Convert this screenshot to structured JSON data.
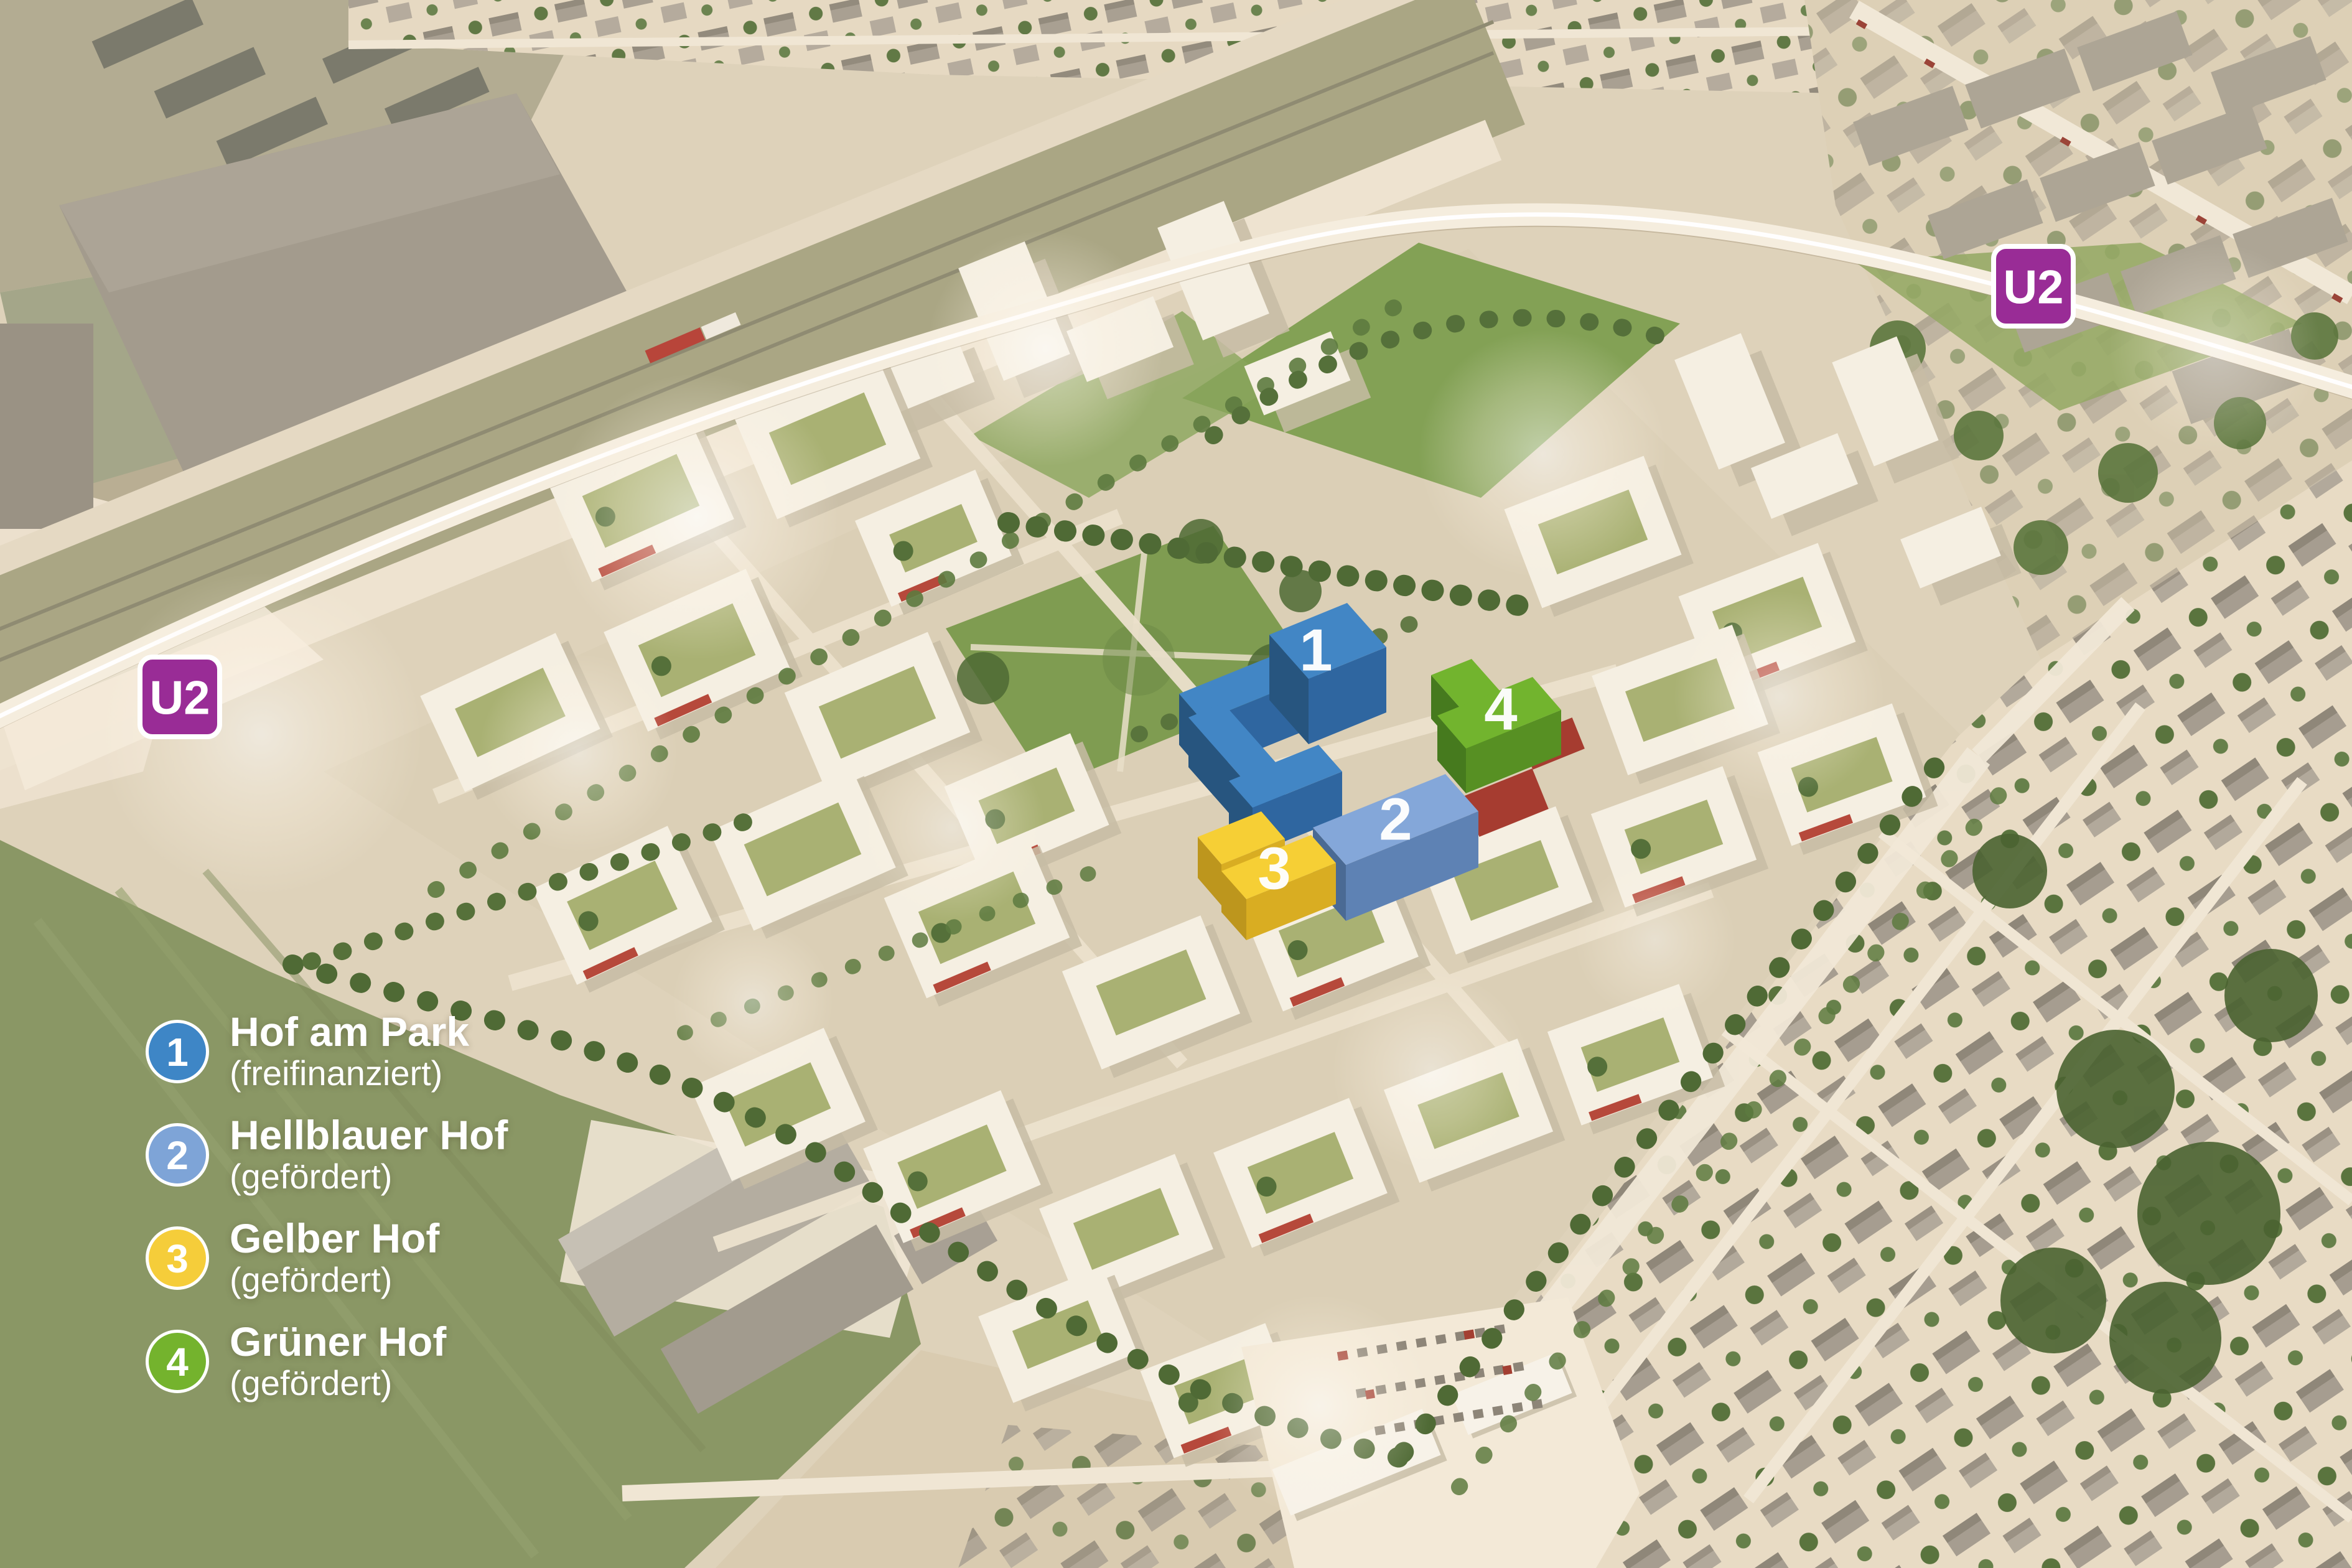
{
  "scene": {
    "description": "Aerial masterplan rendering of a new housing quarter along the U2 metro line",
    "ground_color": "#ded2ba"
  },
  "u2_line": {
    "badge_color": "#992c96",
    "badge_border": "#ffffff"
  },
  "badges": [
    {
      "id": "west",
      "label": "U2"
    },
    {
      "id": "east",
      "label": "U2"
    }
  ],
  "buildings": [
    {
      "number": "1",
      "name": "Hof am Park",
      "status": "(freifinanziert)",
      "legend_color": "#3e86c6",
      "roof_color": "#4286c5",
      "side_color": "#2f66a0",
      "dark_color": "#27557f"
    },
    {
      "number": "2",
      "name": "Hellblauer Hof",
      "status": "(gefördert)",
      "legend_color": "#7ea4d7",
      "roof_color": "#84a7d9",
      "side_color": "#5e82b4",
      "dark_color": "#4a6a94"
    },
    {
      "number": "3",
      "name": "Gelber Hof",
      "status": "(gefördert)",
      "legend_color": "#f5cd3a",
      "roof_color": "#f6cf35",
      "side_color": "#d9ad22",
      "dark_color": "#bd961d"
    },
    {
      "number": "4",
      "name": "Grüner Hof",
      "status": "(gefördert)",
      "legend_color": "#74b32d",
      "roof_color": "#72b42e",
      "side_color": "#579023",
      "dark_color": "#467a1e"
    }
  ]
}
